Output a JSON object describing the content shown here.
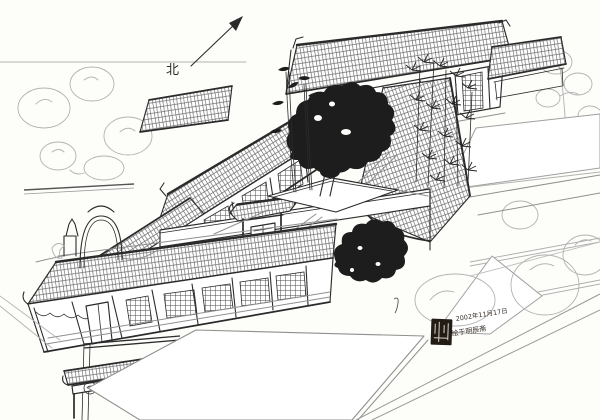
{
  "compass": {
    "label": "北"
  },
  "inscription": {
    "date_line": "2002年11月17日",
    "studio_line": "绘于明辰斋"
  },
  "colors": {
    "paper": "#fdfdfa",
    "ink": "#2b2b2b",
    "light_sketch": "#b2b2b2",
    "foliage": "#1d1d1d",
    "seal": "#231c15"
  }
}
